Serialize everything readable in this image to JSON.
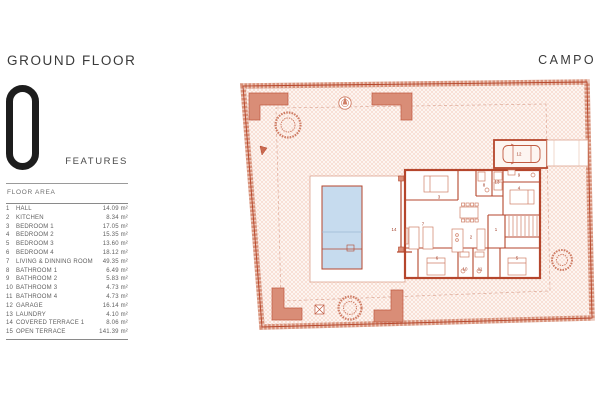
{
  "header": {
    "title": "GROUND FLOOR",
    "floor_number": "0",
    "features_label": "FEATURES",
    "location_label": "CAMPO"
  },
  "floor_area": {
    "label": "FLOOR AREA",
    "rows": [
      {
        "num": "1",
        "name": "HALL",
        "area": "14.09 m²"
      },
      {
        "num": "2",
        "name": "KITCHEN",
        "area": "8.34 m²"
      },
      {
        "num": "3",
        "name": "BEDROOM 1",
        "area": "17.05 m²"
      },
      {
        "num": "4",
        "name": "BEDROOM 2",
        "area": "15.35 m²"
      },
      {
        "num": "5",
        "name": "BEDROOM 3",
        "area": "13.60 m²"
      },
      {
        "num": "6",
        "name": "BEDROOM 4",
        "area": "18.12 m²"
      },
      {
        "num": "7",
        "name": "LIVING & DINNING ROOM",
        "area": "49.35 m²"
      },
      {
        "num": "8",
        "name": "BATHROOM 1",
        "area": "6.49 m²"
      },
      {
        "num": "9",
        "name": "BATHROOM 2",
        "area": "5.83 m²"
      },
      {
        "num": "10",
        "name": "BATHROOM 3",
        "area": "4.73 m²"
      },
      {
        "num": "11",
        "name": "BATHROOM 4",
        "area": "4.73 m²"
      },
      {
        "num": "12",
        "name": "GARAGE",
        "area": "16.14 m²"
      },
      {
        "num": "13",
        "name": "LAUNDRY",
        "area": "4.10 m²"
      },
      {
        "num": "14",
        "name": "COVERED TERRACE 1",
        "area": "8.06 m²"
      },
      {
        "num": "15",
        "name": "OPEN TERRACE",
        "area": "141.39 m²"
      }
    ]
  },
  "plan": {
    "colors": {
      "wall": "#b5462c",
      "hatch": "#f0c5b5",
      "hatch_bg": "#fdf5f1",
      "planter": "#d98d77",
      "pool": "#c6dbee",
      "text": "#a03b24"
    }
  }
}
